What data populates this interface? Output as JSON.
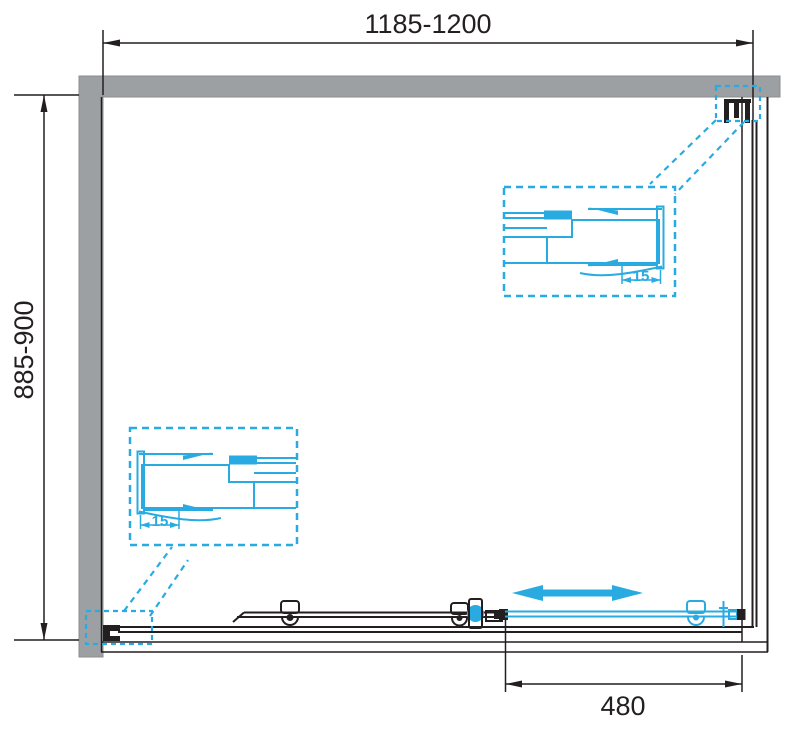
{
  "page": {
    "title": "Shower enclosure plan technical drawing"
  },
  "colors": {
    "accent": "#29ABE2",
    "line": "#231F20",
    "wall": "#9DA0A3",
    "wall-border": "#8A8C8F",
    "bg": "#FFFFFF"
  },
  "dimensions": {
    "top": {
      "label": "1185-1200"
    },
    "left": {
      "label": "885-900"
    },
    "bottom": {
      "label": "480"
    }
  },
  "details": {
    "top": {
      "adjustment_label": "15"
    },
    "bottom": {
      "adjustment_label": "15"
    }
  },
  "icons": {
    "slide_direction_arrow": "double-arrow-icon"
  }
}
